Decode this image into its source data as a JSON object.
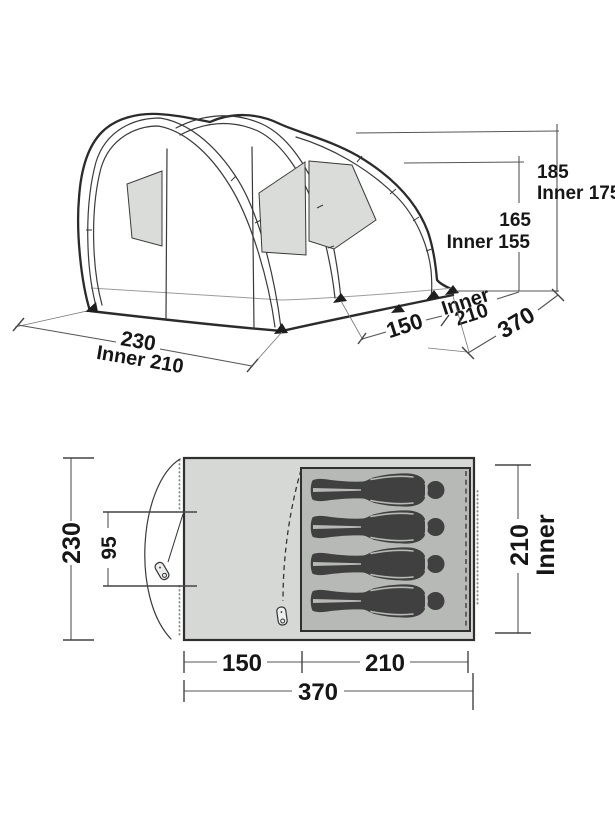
{
  "perspective_view": {
    "peak_height": "185",
    "peak_height_inner": "Inner 175",
    "tunnel_height": "165",
    "tunnel_height_inner": "Inner 155",
    "front_width": "230",
    "front_width_inner": "Inner 210",
    "porch_length": "150",
    "inner_length_word": "Inner",
    "inner_length_value": "210",
    "total_length": "370"
  },
  "floor_plan": {
    "overall_width": "230",
    "door_opening": "95",
    "porch_length": "150",
    "inner_length": "210",
    "total_length": "370",
    "inner_width_value": "210",
    "inner_width_word": "Inner",
    "sleeper_count": 4
  },
  "colors": {
    "background": "#ffffff",
    "outline": "#2b2b2b",
    "dimension_line": "#555555",
    "floor_fill": "#d6d8d5",
    "inner_fill": "#b7b9b6",
    "window_fill": "#dadcd9",
    "figure_fill": "#3f403f",
    "dotted_line": "#8f918e"
  }
}
